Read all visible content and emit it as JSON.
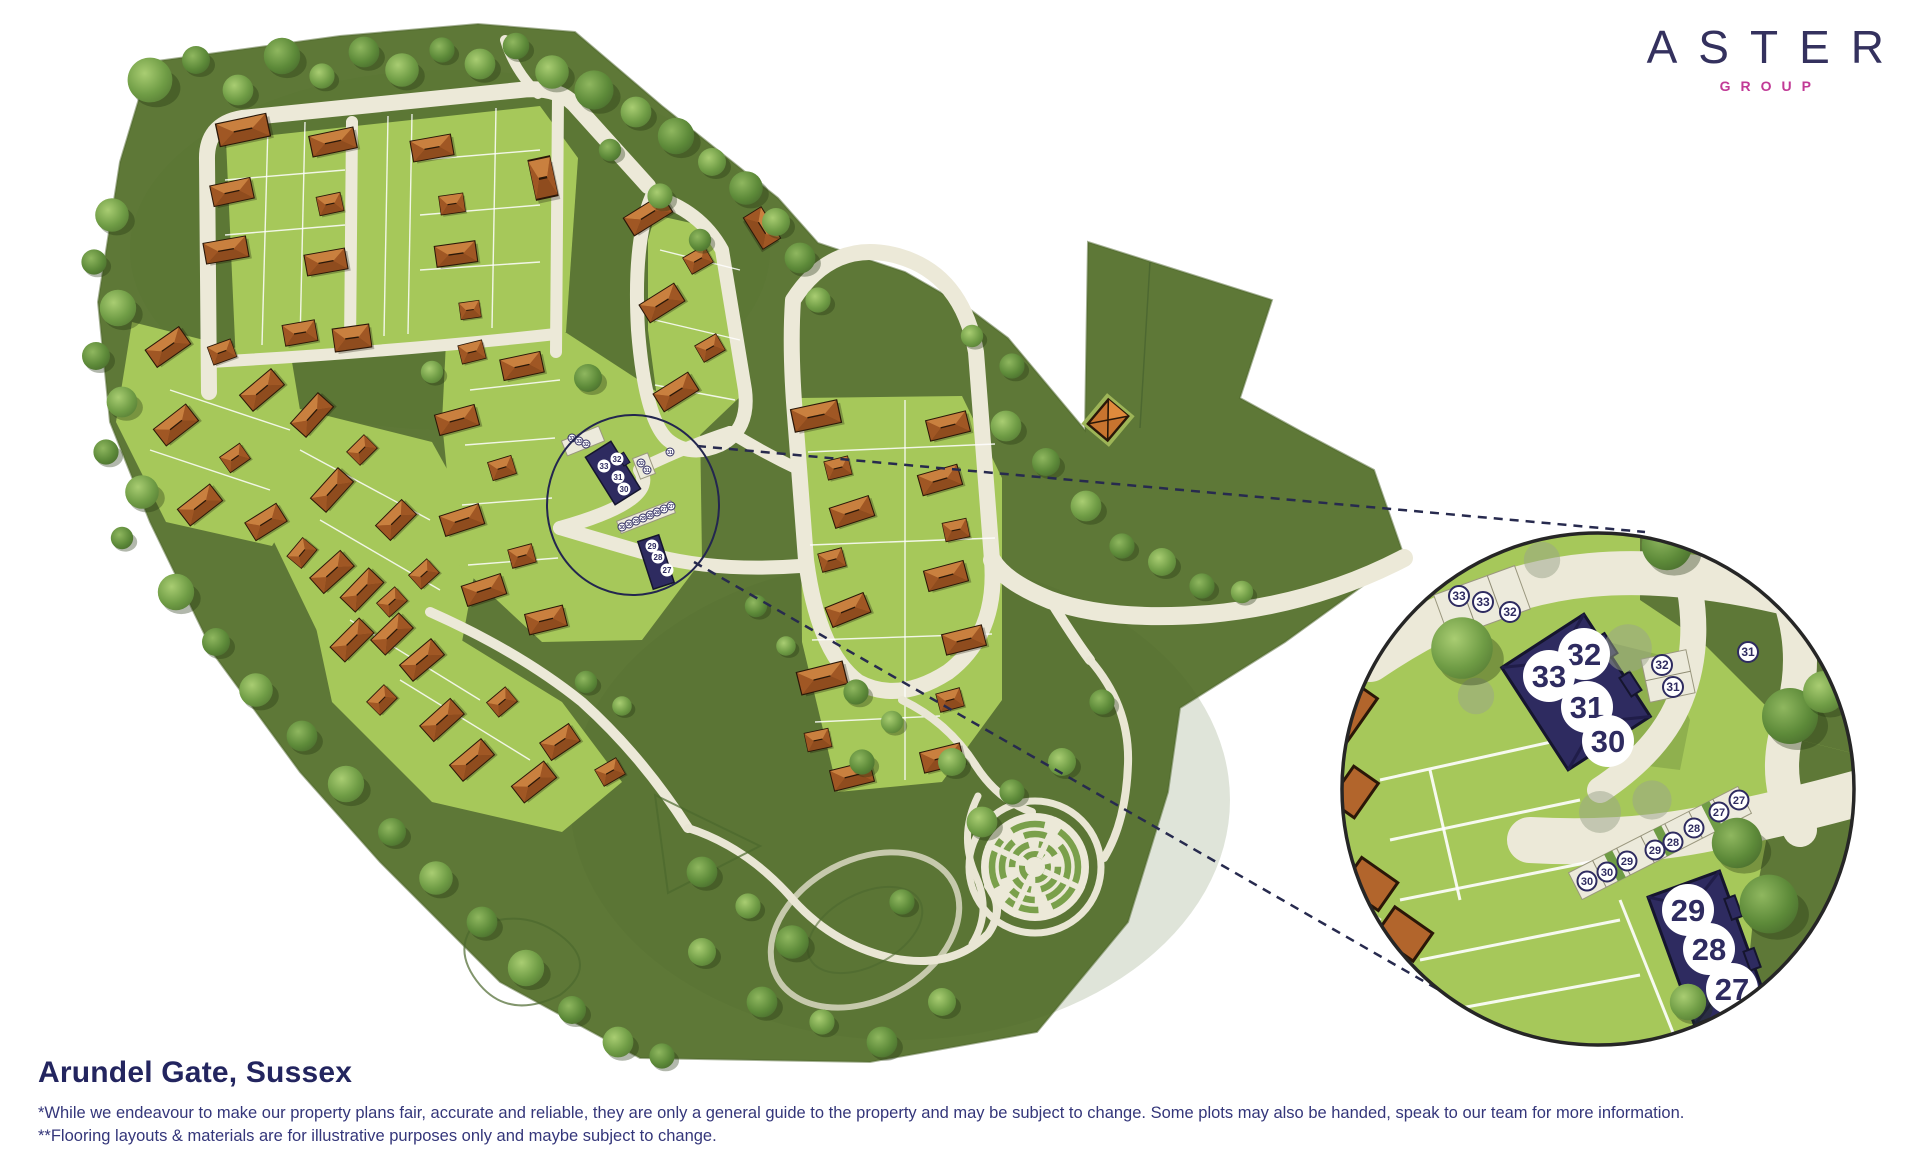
{
  "brand": {
    "name": "ASTER",
    "subtitle": "GROUP"
  },
  "footer": {
    "title": "Arundel Gate, Sussex",
    "disclaimer_line1": "*While we endeavour to make our property plans fair, accurate and reliable, they are only a general guide to the property and may be subject to change. Some plots may also be handed, speak to our team for more information.",
    "disclaimer_line2": "**Flooring layouts & materials are for illustrative purposes only and maybe subject to change."
  },
  "detail": {
    "parking_top": [
      "33",
      "33",
      "32"
    ],
    "building_top": [
      "32",
      "33",
      "31",
      "30"
    ],
    "parking_side": [
      "32",
      "31"
    ],
    "road_plot": "31",
    "parking_row": [
      "30",
      "30",
      "29",
      "29",
      "28",
      "28",
      "27",
      "27"
    ],
    "building_bottom": [
      "29",
      "28",
      "27"
    ]
  },
  "colors": {
    "brand_navy": "#34315e",
    "brand_magenta": "#c13a96",
    "plot_navy": "#2e2b60",
    "site_olive": "#5e7837",
    "parcel_green": "#a6c85a",
    "road_cream": "#ece9d8",
    "roof_orange": "#b2652c",
    "text_navy": "#34367a"
  },
  "icons": {
    "map": "masterplan-illustration",
    "detail": "magnified-detail-circle"
  }
}
